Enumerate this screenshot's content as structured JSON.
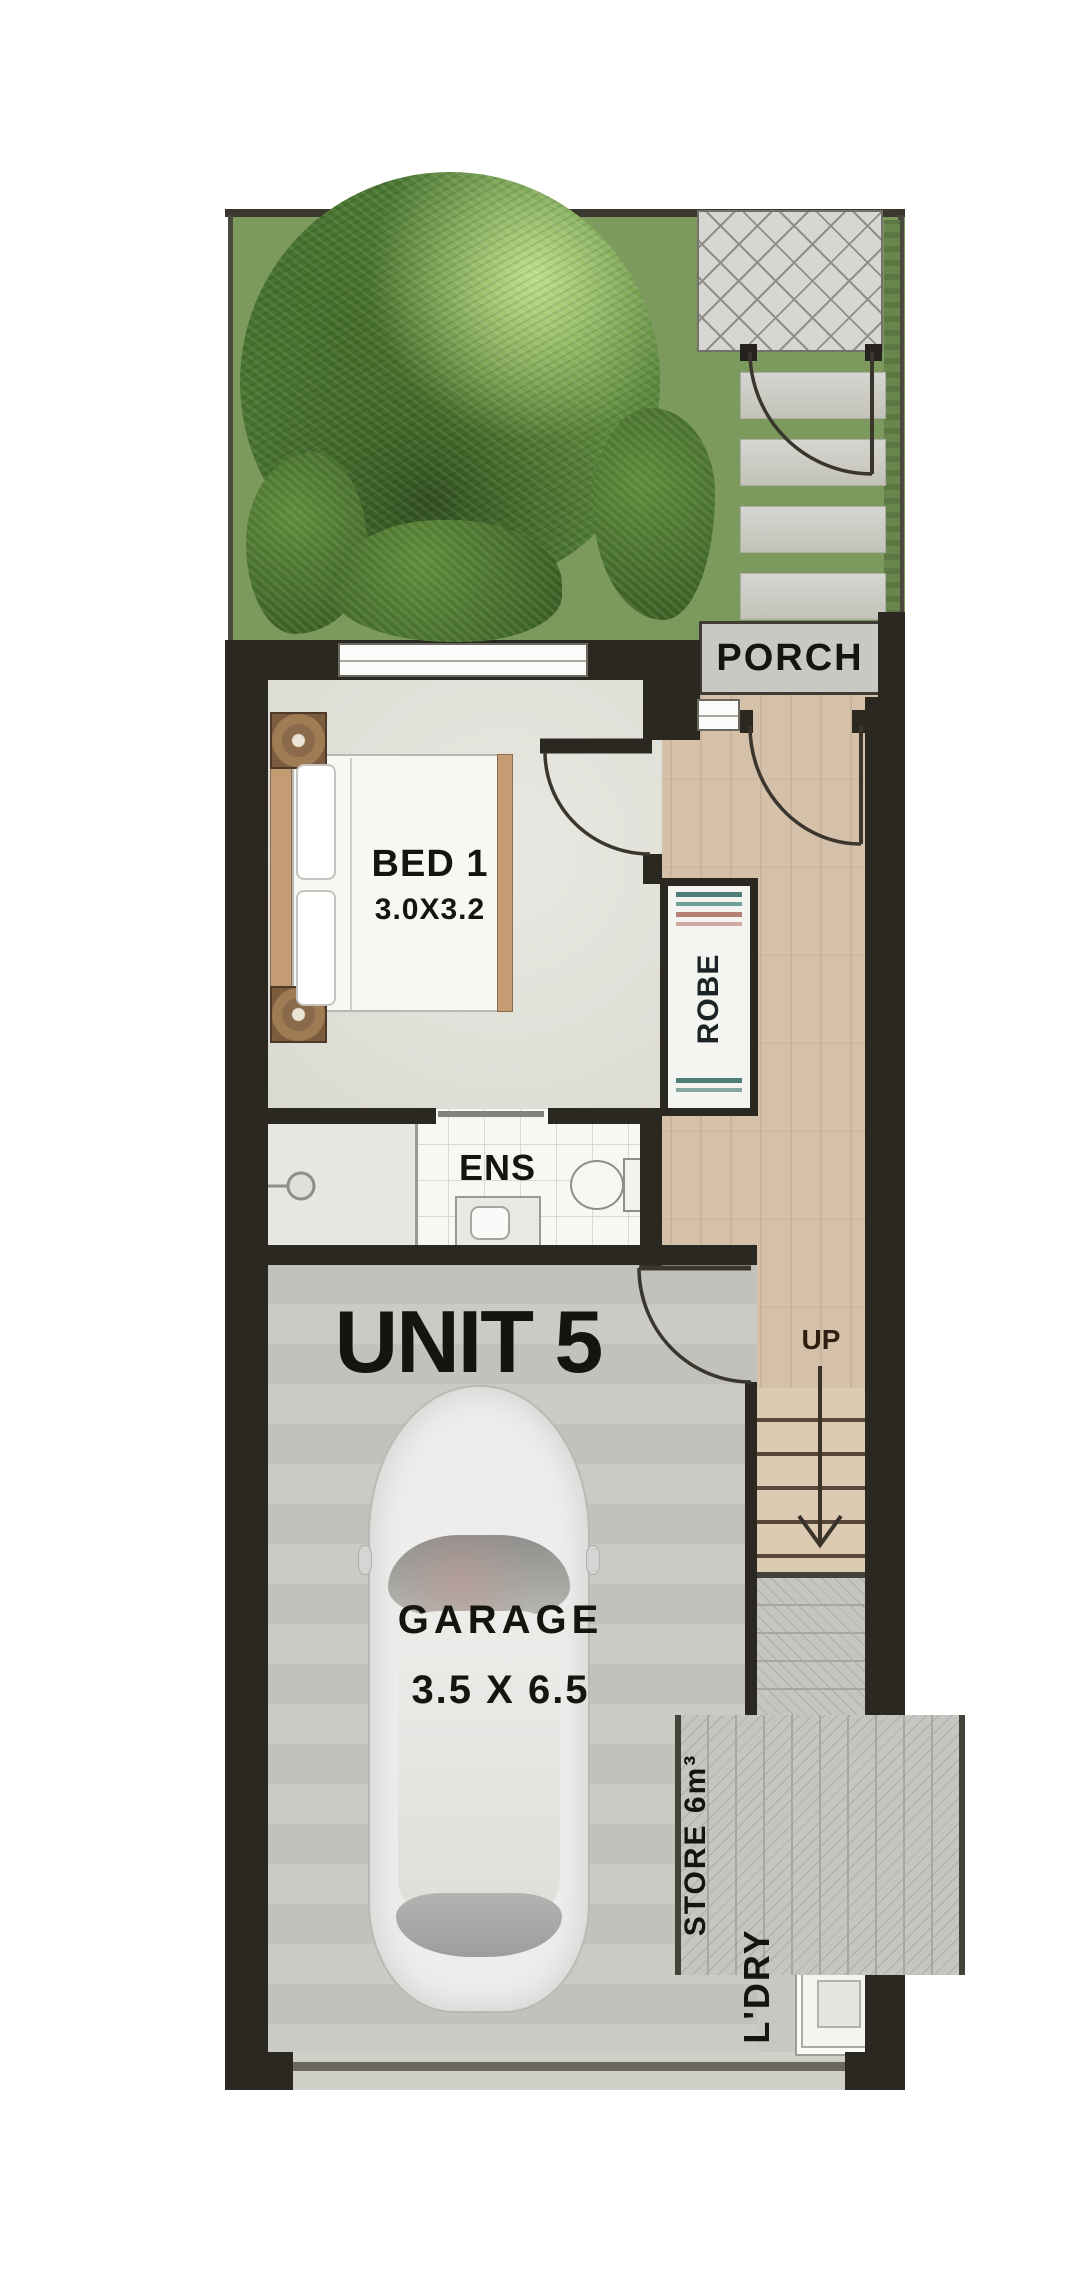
{
  "palette": {
    "wall": "#2b2822",
    "grass": "#7d9a5e",
    "timber_floor": "#d5c1a9",
    "garage_floor": "#c7c8c2",
    "tile_white": "#f7f7f4",
    "paver_gray": "#d6d6d2",
    "label_text": "#15150f"
  },
  "floorplan": {
    "unit": {
      "title": "UNIT 5"
    },
    "porch": {
      "label": "PORCH"
    },
    "bedroom": {
      "label": "BED 1",
      "dimensions": "3.0X3.2"
    },
    "robe": {
      "label": "ROBE"
    },
    "ensuite": {
      "label": "ENS"
    },
    "stairs": {
      "label": "UP"
    },
    "garage": {
      "label": "GARAGE",
      "dimensions": "3.5 X 6.5"
    },
    "store": {
      "label": "STORE 6m³"
    },
    "laundry": {
      "label": "L'DRY"
    }
  }
}
